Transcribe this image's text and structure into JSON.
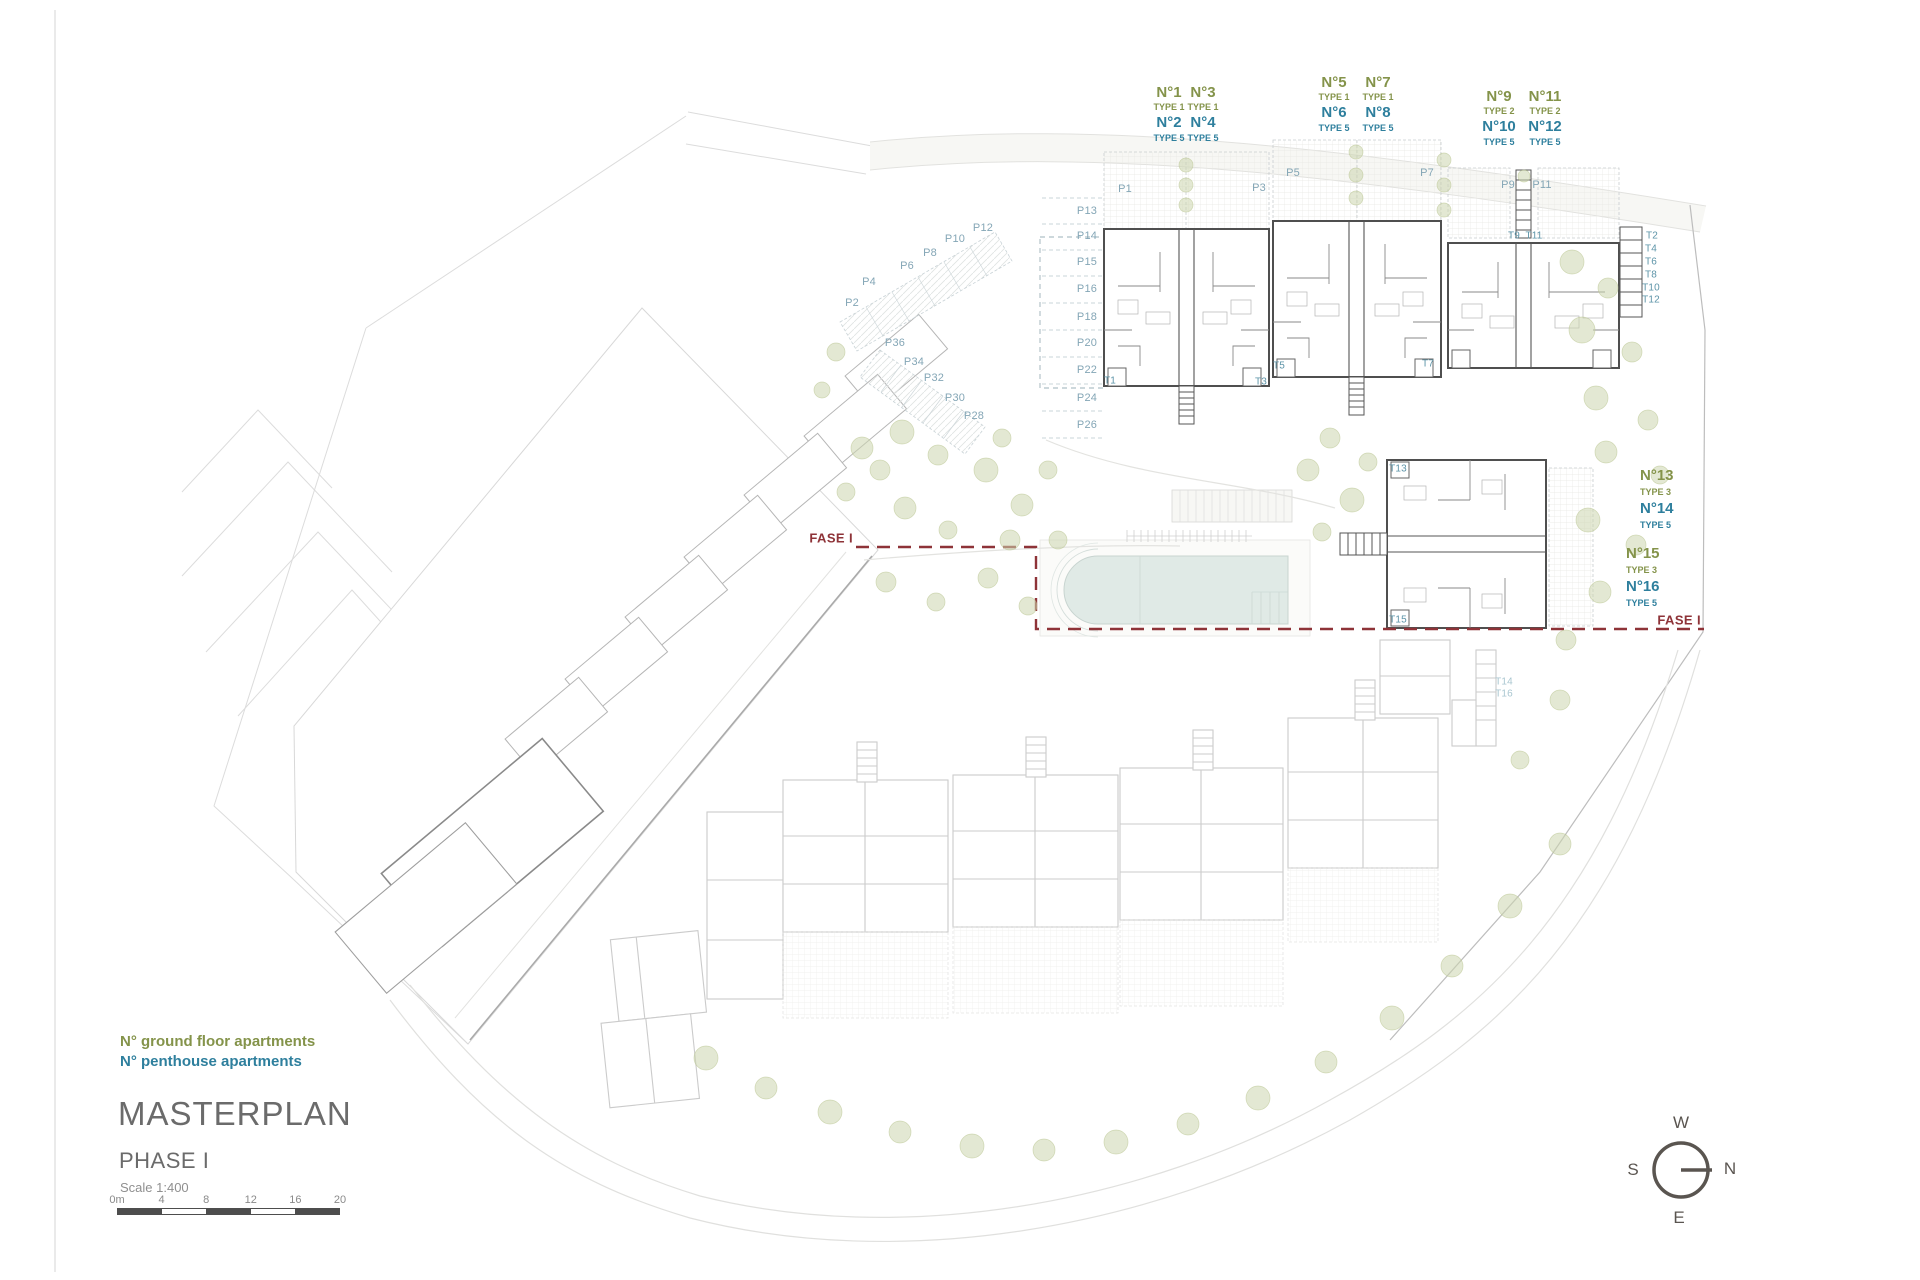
{
  "colors": {
    "ground_floor": "#84934a",
    "penthouse": "#2e7f9d",
    "phase_line": "#8e3338",
    "parking_label": "#84a6b6",
    "stair_label": "#5d94a8",
    "title_gray": "#6b6b6b",
    "pool_water": "#e0eae6"
  },
  "legend": {
    "ground": "N° ground floor apartments",
    "penthouse": "N° penthouse apartments"
  },
  "title_block": {
    "title": "MASTERPLAN",
    "phase": "PHASE I",
    "scale": "Scale 1:400"
  },
  "scale_bar": {
    "ticks": [
      "0m",
      "4",
      "8",
      "12",
      "16",
      "20"
    ]
  },
  "compass": {
    "west": "W",
    "south": "S",
    "north": "N",
    "east": "E"
  },
  "phase_boundary": {
    "left_label": "FASE I",
    "right_label": "FASE I"
  },
  "apartment_groups": [
    {
      "id": "units-1-4",
      "x": 1186,
      "y": 84,
      "col_gap": 34,
      "columns": [
        {
          "ground": "N°1",
          "ground_type": "TYPE 1",
          "penthouse": "N°2",
          "penthouse_type": "TYPE 5"
        },
        {
          "ground": "N°3",
          "ground_type": "TYPE 1",
          "penthouse": "N°4",
          "penthouse_type": "TYPE 5"
        }
      ]
    },
    {
      "id": "units-5-8",
      "x": 1356,
      "y": 74,
      "col_gap": 44,
      "columns": [
        {
          "ground": "N°5",
          "ground_type": "TYPE 1",
          "penthouse": "N°6",
          "penthouse_type": "TYPE 5"
        },
        {
          "ground": "N°7",
          "ground_type": "TYPE 1",
          "penthouse": "N°8",
          "penthouse_type": "TYPE 5"
        }
      ]
    },
    {
      "id": "units-9-12",
      "x": 1522,
      "y": 88,
      "col_gap": 46,
      "columns": [
        {
          "ground": "N°9",
          "ground_type": "TYPE 2",
          "penthouse": "N°10",
          "penthouse_type": "TYPE 5"
        },
        {
          "ground": "N°11",
          "ground_type": "TYPE 2",
          "penthouse": "N°12",
          "penthouse_type": "TYPE 5"
        }
      ]
    }
  ],
  "side_groups": [
    {
      "id": "units-13-14",
      "x": 1640,
      "y": 466,
      "ground": "N°13",
      "ground_type": "TYPE 3",
      "penthouse": "N°14",
      "penthouse_type": "TYPE 5"
    },
    {
      "id": "units-15-16",
      "x": 1626,
      "y": 544,
      "ground": "N°15",
      "ground_type": "TYPE 3",
      "penthouse": "N°16",
      "penthouse_type": "TYPE 5"
    }
  ],
  "garden_labels": [
    {
      "text": "P1",
      "x": 1125,
      "y": 189
    },
    {
      "text": "P3",
      "x": 1259,
      "y": 188
    },
    {
      "text": "P5",
      "x": 1293,
      "y": 173
    },
    {
      "text": "P7",
      "x": 1427,
      "y": 173
    },
    {
      "text": "P9",
      "x": 1508,
      "y": 185
    },
    {
      "text": "P11",
      "x": 1542,
      "y": 185
    }
  ],
  "parking_diagonal": [
    {
      "text": "P2",
      "x": 852,
      "y": 303
    },
    {
      "text": "P4",
      "x": 869,
      "y": 282
    },
    {
      "text": "P6",
      "x": 907,
      "y": 266
    },
    {
      "text": "P8",
      "x": 930,
      "y": 253
    },
    {
      "text": "P10",
      "x": 955,
      "y": 239
    },
    {
      "text": "P12",
      "x": 983,
      "y": 228
    },
    {
      "text": "P28",
      "x": 974,
      "y": 416
    },
    {
      "text": "P30",
      "x": 955,
      "y": 398
    },
    {
      "text": "P32",
      "x": 934,
      "y": 378
    },
    {
      "text": "P34",
      "x": 914,
      "y": 362
    },
    {
      "text": "P36",
      "x": 895,
      "y": 343
    }
  ],
  "parking_column": [
    {
      "text": "P13",
      "x": 1087,
      "y": 211
    },
    {
      "text": "P14",
      "x": 1087,
      "y": 236
    },
    {
      "text": "P15",
      "x": 1087,
      "y": 262
    },
    {
      "text": "P16",
      "x": 1087,
      "y": 289
    },
    {
      "text": "P18",
      "x": 1087,
      "y": 317
    },
    {
      "text": "P20",
      "x": 1087,
      "y": 343
    },
    {
      "text": "P22",
      "x": 1087,
      "y": 370
    },
    {
      "text": "P24",
      "x": 1087,
      "y": 398
    },
    {
      "text": "P26",
      "x": 1087,
      "y": 425
    }
  ],
  "stair_labels": [
    {
      "text": "T1",
      "x": 1110,
      "y": 381
    },
    {
      "text": "T3",
      "x": 1261,
      "y": 382
    },
    {
      "text": "T5",
      "x": 1279,
      "y": 366
    },
    {
      "text": "T7",
      "x": 1428,
      "y": 364
    },
    {
      "text": "T9",
      "x": 1514,
      "y": 236
    },
    {
      "text": "T11",
      "x": 1534,
      "y": 236
    },
    {
      "text": "T13",
      "x": 1398,
      "y": 469
    },
    {
      "text": "T15",
      "x": 1398,
      "y": 620
    },
    {
      "text": "T2",
      "x": 1652,
      "y": 236
    },
    {
      "text": "T4",
      "x": 1651,
      "y": 249
    },
    {
      "text": "T6",
      "x": 1651,
      "y": 262
    },
    {
      "text": "T8",
      "x": 1651,
      "y": 275
    },
    {
      "text": "T10",
      "x": 1651,
      "y": 288
    },
    {
      "text": "T12",
      "x": 1651,
      "y": 300
    }
  ],
  "stair_labels_faded": [
    {
      "text": "T14",
      "x": 1504,
      "y": 682
    },
    {
      "text": "T16",
      "x": 1504,
      "y": 694
    }
  ]
}
